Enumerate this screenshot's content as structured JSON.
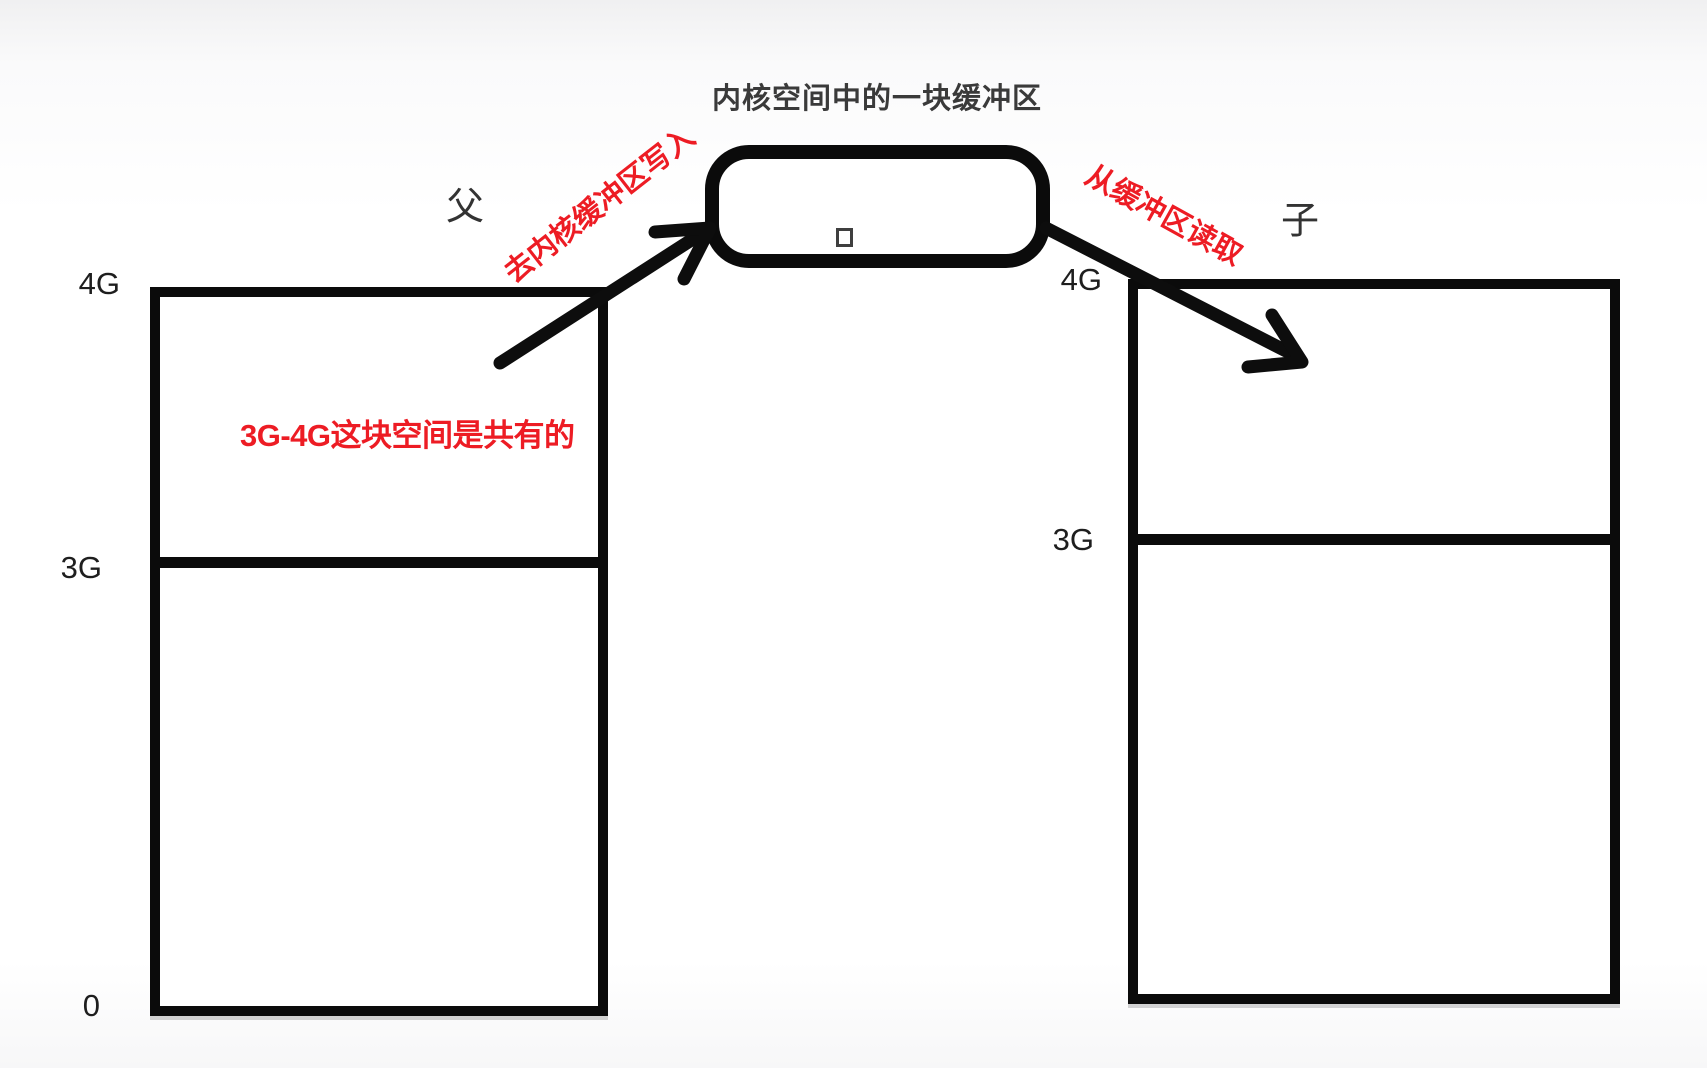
{
  "title": "内核空间中的一块缓冲区",
  "buffer": {
    "square_icon": "small-square"
  },
  "parent": {
    "label": "父",
    "ticks": [
      "4G",
      "3G",
      "0"
    ]
  },
  "child": {
    "label": "子",
    "ticks": [
      "4G",
      "3G"
    ]
  },
  "annotations": {
    "write": "去内核缓冲区写入",
    "read": "从缓冲区读取",
    "shared": "3G-4G这块空间是共有的"
  },
  "colors": {
    "annotation_red": "#ed1c24",
    "ink_black": "#0b0b0b"
  }
}
